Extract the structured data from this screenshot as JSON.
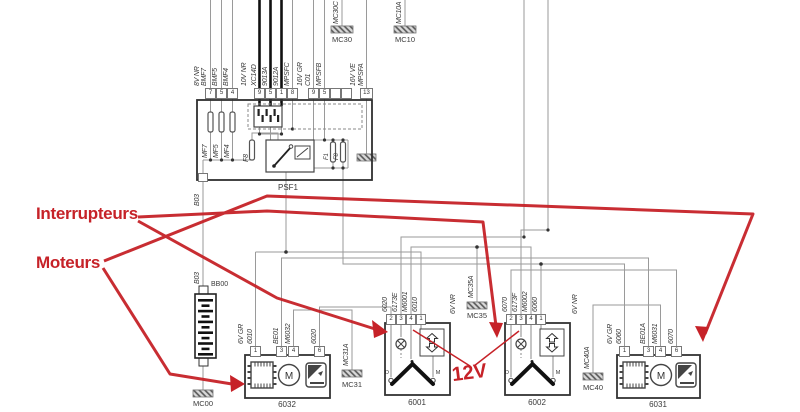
{
  "annotations": {
    "switches": "Interrupteurs",
    "motors": "Moteurs",
    "voltage": "12V"
  },
  "colors": {
    "annotation_red": "#c62228",
    "wire_gray": "#9a9a9a",
    "thick_black": "#111111"
  },
  "psf1": {
    "label": "PSF1",
    "fuse_mf7": "MF7",
    "fuse_mf5": "MF5",
    "fuse_mf4": "MF4",
    "fuse_f8": "F8",
    "fuse_f1": "F1",
    "fuse_f8b": "F8"
  },
  "top_connectors": {
    "g1": {
      "bus": "8V NR",
      "wires": [
        "BMF7",
        "BMF5",
        "BMF4"
      ],
      "pins": [
        "7",
        "5",
        "4"
      ]
    },
    "g2": {
      "bus": "10V NR",
      "wires": [
        "XC14D",
        "9013A",
        "9012A",
        "MPSFC"
      ],
      "pins": [
        "9",
        "5",
        "1",
        "8"
      ]
    },
    "g3": {
      "bus": "16V GR",
      "wires": [
        "C01",
        "MPSFB"
      ],
      "pins": [
        "9",
        "5"
      ]
    },
    "g4": {
      "bus": "16V VE",
      "wires": [
        "MPSFA"
      ],
      "pins": [
        "13"
      ]
    }
  },
  "grounds": {
    "mc30": {
      "wire": "MC30C",
      "label": "MC30"
    },
    "mc10": {
      "wire": "MC10A",
      "label": "MC10"
    },
    "mc31": {
      "wire": "MC31A",
      "label": "MC31"
    },
    "mc35": {
      "wire": "MC35A",
      "label": "MC35"
    },
    "mc40": {
      "wire": "MC40A",
      "label": "MC40"
    },
    "mc00": {
      "label": "MC00"
    }
  },
  "battery": {
    "label": "BB00",
    "wire_upper": "B03",
    "wire_lower": "B03"
  },
  "sw": {
    "left": "D",
    "right": "M"
  },
  "components": {
    "m6032": {
      "id": "6032",
      "bus": "6V GR",
      "motor": "M",
      "wires": [
        "6010",
        "BE01",
        "M6032",
        "6020"
      ],
      "pins": [
        "1",
        "3",
        "4",
        "6"
      ]
    },
    "s6001": {
      "id": "6001",
      "bus": "6V NR",
      "wires": [
        "6020",
        "6173E",
        "M6001",
        "6010"
      ],
      "pins": [
        "2",
        "3",
        "4",
        "1"
      ]
    },
    "s6002": {
      "id": "6002",
      "bus": "6V NR",
      "wires": [
        "6070",
        "6173F",
        "M6002",
        "6060"
      ],
      "pins": [
        "2",
        "3",
        "4",
        "1"
      ]
    },
    "m6031": {
      "id": "6031",
      "bus": "6V GR",
      "motor": "M",
      "wires": [
        "6060",
        "BE01A",
        "M6031",
        "6070"
      ],
      "pins": [
        "1",
        "3",
        "4",
        "6"
      ]
    }
  }
}
